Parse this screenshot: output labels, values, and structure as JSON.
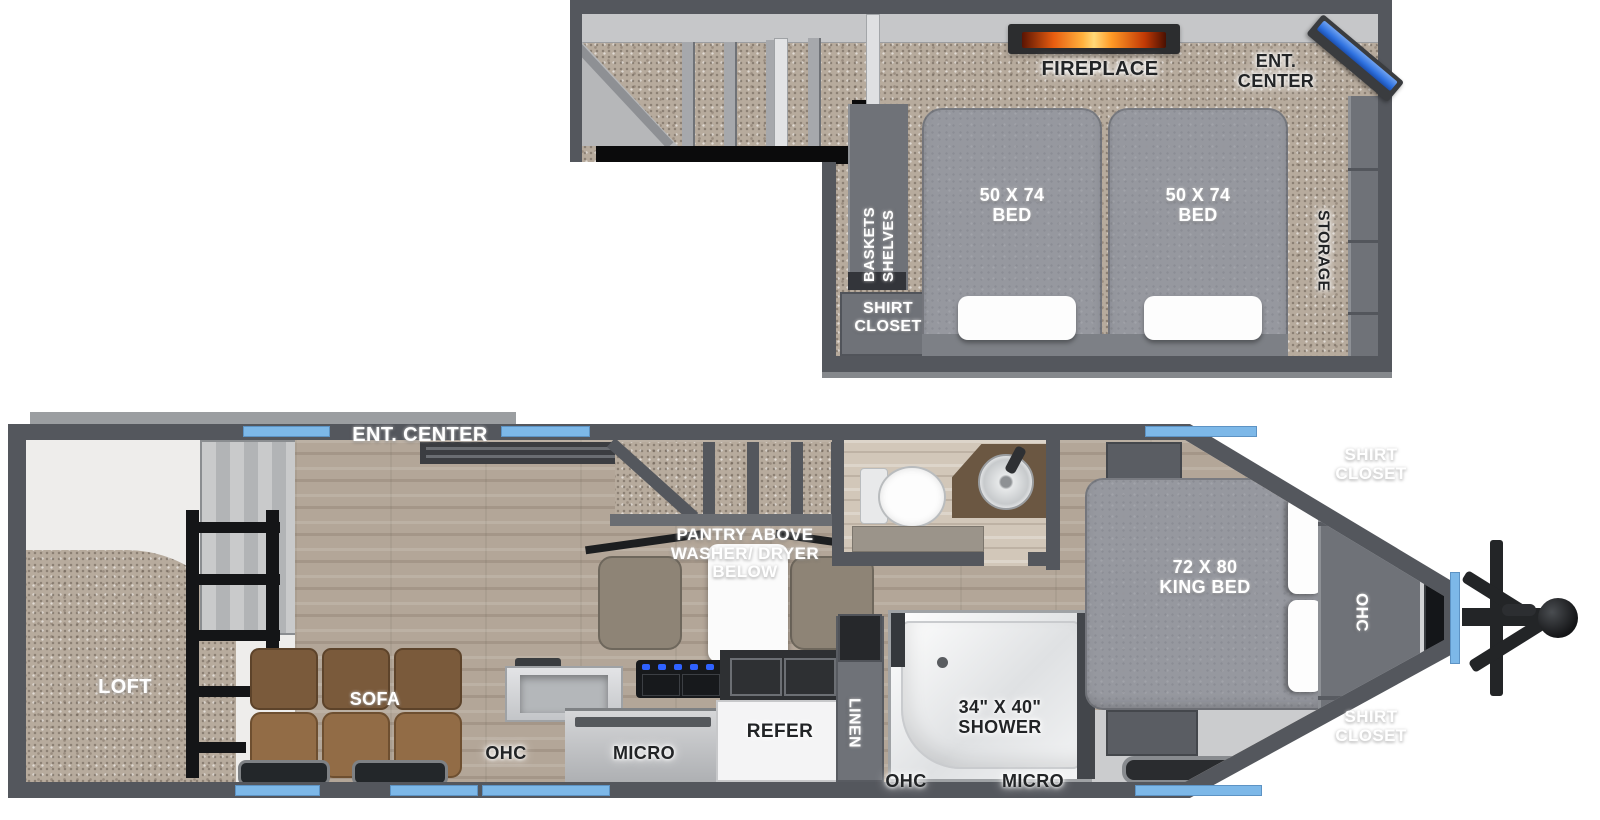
{
  "meta": {
    "diagram_type": "rv-travel-trailer-floorplan",
    "views": [
      "upper-deck",
      "main-deck"
    ]
  },
  "colors": {
    "wall": "#54575d",
    "wall_light": "#c6c7c9",
    "carpet": "#b7ab9d",
    "wood": "#b3a698",
    "cabinet": "#6f7278",
    "bed": "#96989f",
    "window_blue": "#7db8e8",
    "tv_blue": "#2f72e0",
    "fire_orange": "#ff9d2c",
    "sofa_brown": "#8a6543",
    "hitch_black": "#232527"
  },
  "upper_deck": {
    "fireplace": "FIREPLACE",
    "ent_center": [
      "ENT.",
      "CENTER"
    ],
    "storage": "STORAGE",
    "baskets_shelves": [
      "BASKETS",
      "SHELVES"
    ],
    "shirt_closet": [
      "SHIRT",
      "CLOSET"
    ],
    "bed_left": [
      "50 X 74",
      "BED"
    ],
    "bed_right": [
      "50 X 74",
      "BED"
    ]
  },
  "main_deck": {
    "loft": "LOFT",
    "ent_center": "ENT. CENTER",
    "pantry": [
      "PANTRY ABOVE",
      "WASHER/ DRYER",
      "BELOW"
    ],
    "sofa": "SOFA",
    "ohc_kitchen": "OHC",
    "micro_kitchen": "MICRO",
    "refer": "REFER",
    "linen": "LINEN",
    "shower": [
      "34\" X 40\"",
      "SHOWER"
    ],
    "ohc_bottom": "OHC",
    "micro_bottom": "MICRO",
    "king_bed": [
      "72 X 80",
      "KING BED"
    ],
    "shirt_closet_top": [
      "SHIRT",
      "CLOSET"
    ],
    "ohc_front": "OHC",
    "shirt_closet_bottom": [
      "SHIRT",
      "CLOSET"
    ]
  }
}
